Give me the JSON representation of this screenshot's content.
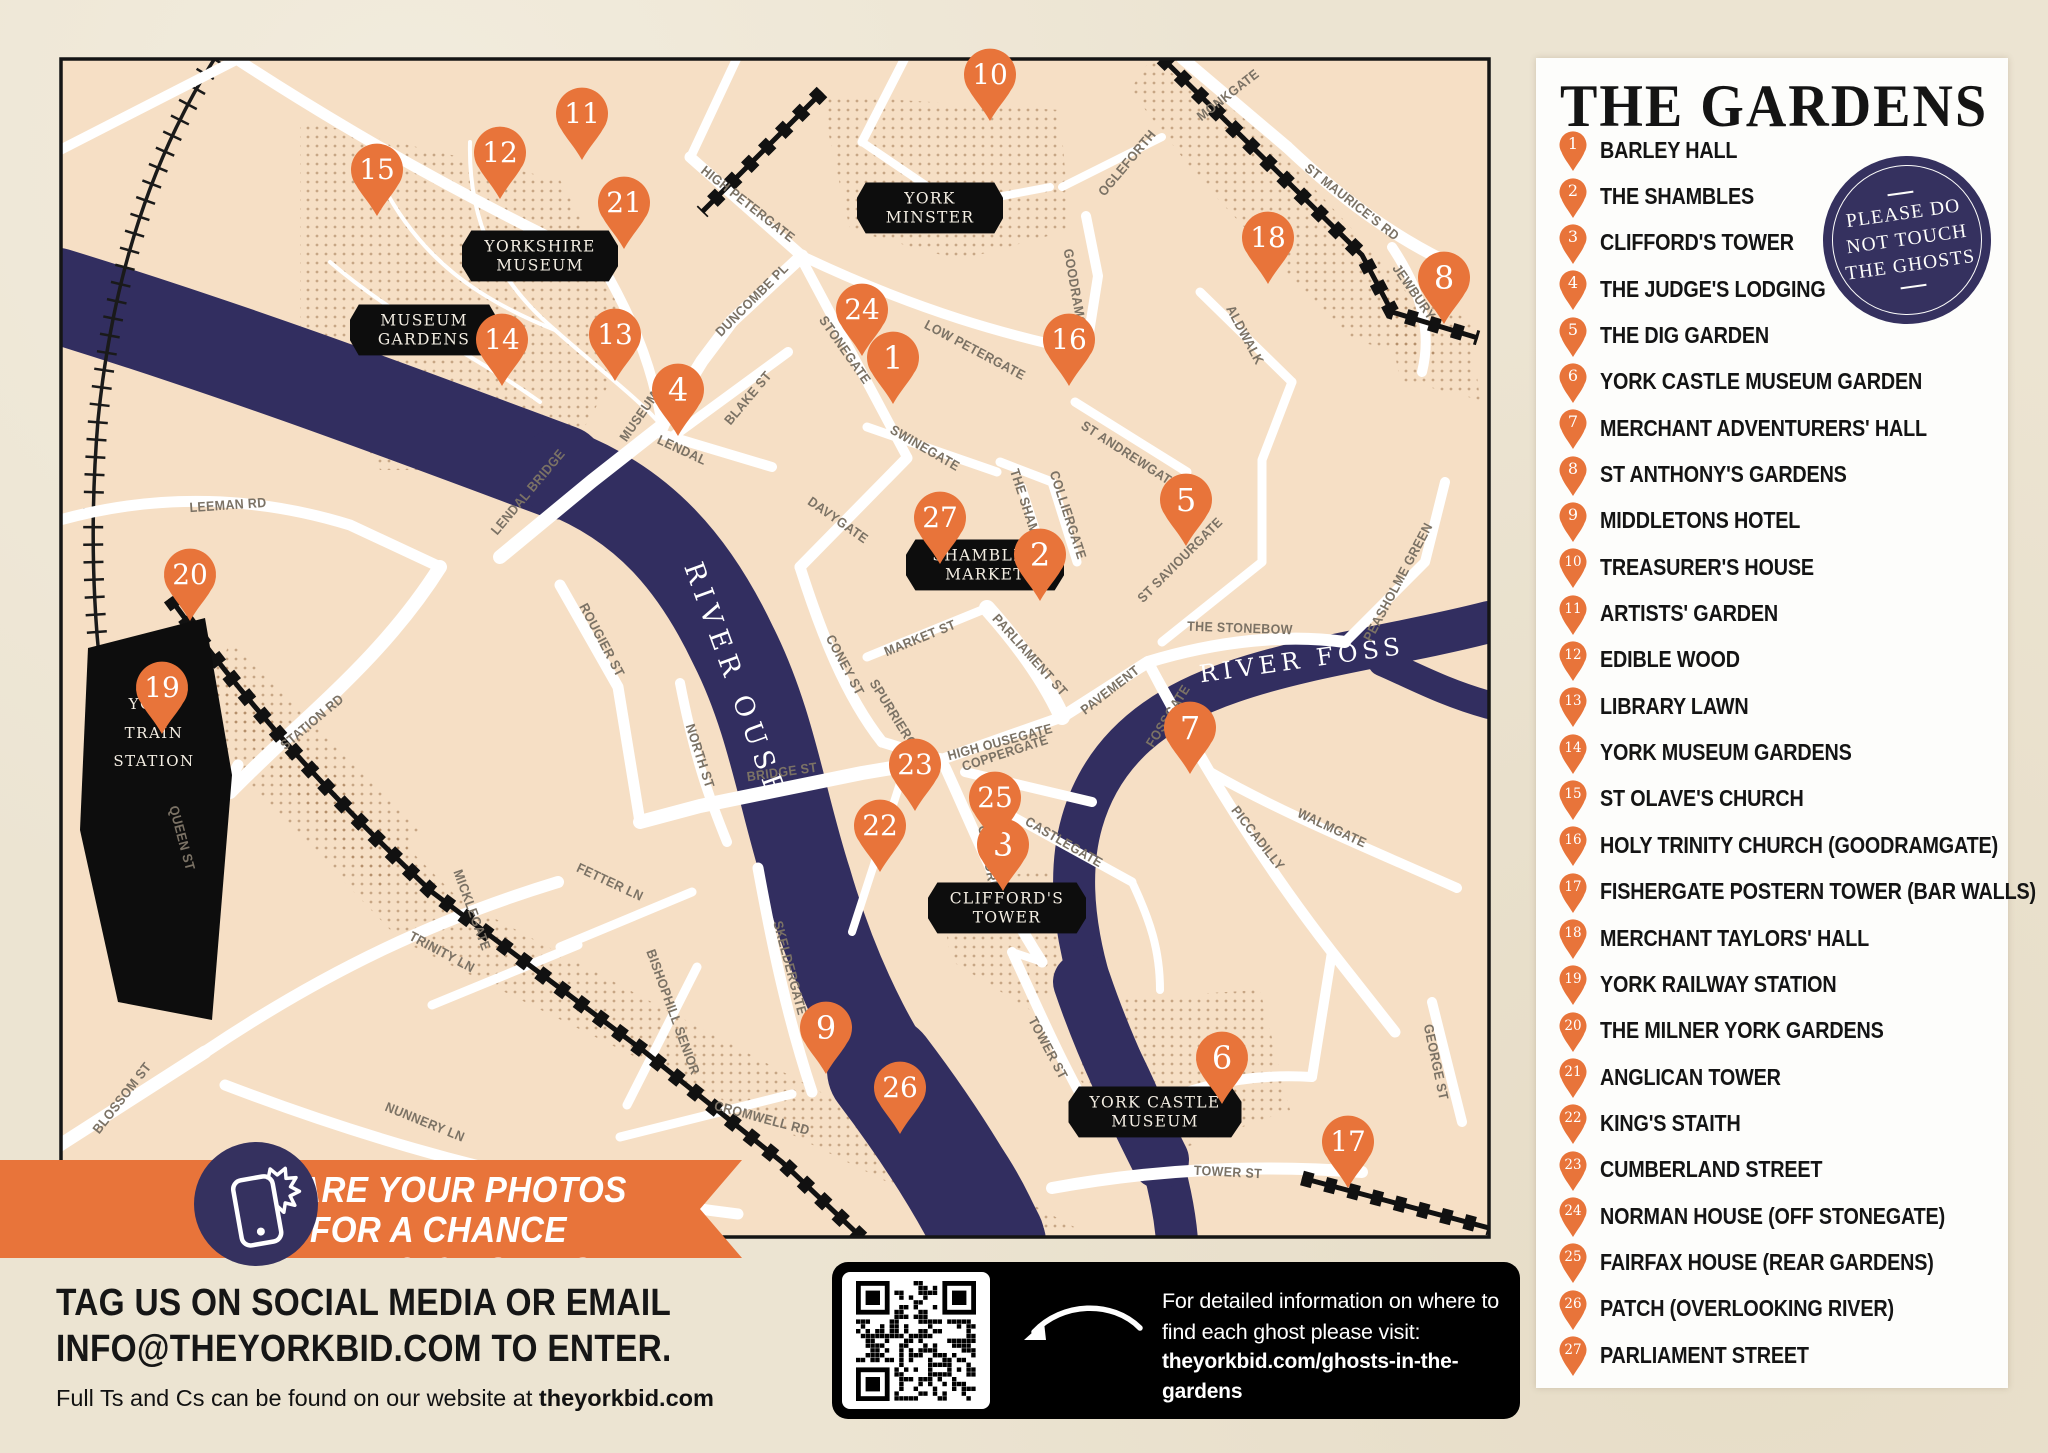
{
  "sidebar": {
    "title": "THE GARDENS",
    "badge": {
      "line1": "PLEASE DO",
      "line2": "NOT TOUCH",
      "line3": "THE GHOSTS"
    },
    "items": [
      {
        "num": "1",
        "label": "BARLEY HALL"
      },
      {
        "num": "2",
        "label": "THE SHAMBLES"
      },
      {
        "num": "3",
        "label": "CLIFFORD'S TOWER"
      },
      {
        "num": "4",
        "label": "THE JUDGE'S LODGING"
      },
      {
        "num": "5",
        "label": "THE DIG GARDEN"
      },
      {
        "num": "6",
        "label": "YORK CASTLE MUSEUM GARDEN"
      },
      {
        "num": "7",
        "label": "MERCHANT ADVENTURERS' HALL"
      },
      {
        "num": "8",
        "label": "ST ANTHONY'S GARDENS"
      },
      {
        "num": "9",
        "label": "MIDDLETONS HOTEL"
      },
      {
        "num": "10",
        "label": "TREASURER'S HOUSE"
      },
      {
        "num": "11",
        "label": "ARTISTS' GARDEN"
      },
      {
        "num": "12",
        "label": "EDIBLE WOOD"
      },
      {
        "num": "13",
        "label": "LIBRARY LAWN"
      },
      {
        "num": "14",
        "label": "YORK MUSEUM GARDENS"
      },
      {
        "num": "15",
        "label": "ST OLAVE'S CHURCH"
      },
      {
        "num": "16",
        "label": "HOLY TRINITY CHURCH (GOODRAMGATE)"
      },
      {
        "num": "17",
        "label": "FISHERGATE POSTERN TOWER (BAR WALLS)"
      },
      {
        "num": "18",
        "label": "MERCHANT TAYLORS' HALL"
      },
      {
        "num": "19",
        "label": "YORK RAILWAY STATION"
      },
      {
        "num": "20",
        "label": "THE MILNER YORK GARDENS"
      },
      {
        "num": "21",
        "label": "ANGLICAN TOWER"
      },
      {
        "num": "22",
        "label": "KING'S STAITH"
      },
      {
        "num": "23",
        "label": "CUMBERLAND STREET"
      },
      {
        "num": "24",
        "label": "NORMAN HOUSE (OFF STONEGATE)"
      },
      {
        "num": "25",
        "label": "FAIRFAX HOUSE (REAR GARDENS)"
      },
      {
        "num": "26",
        "label": "PATCH (OVERLOOKING RIVER)"
      },
      {
        "num": "27",
        "label": "PARLIAMENT STREET"
      }
    ]
  },
  "map": {
    "pins": [
      {
        "n": "1",
        "x": 893,
        "y": 358
      },
      {
        "n": "2",
        "x": 1040,
        "y": 555
      },
      {
        "n": "3",
        "x": 1003,
        "y": 845
      },
      {
        "n": "4",
        "x": 678,
        "y": 390
      },
      {
        "n": "5",
        "x": 1186,
        "y": 500
      },
      {
        "n": "6",
        "x": 1222,
        "y": 1058
      },
      {
        "n": "7",
        "x": 1190,
        "y": 728
      },
      {
        "n": "8",
        "x": 1444,
        "y": 278
      },
      {
        "n": "9",
        "x": 826,
        "y": 1028
      },
      {
        "n": "10",
        "x": 990,
        "y": 75
      },
      {
        "n": "11",
        "x": 582,
        "y": 114
      },
      {
        "n": "12",
        "x": 500,
        "y": 153
      },
      {
        "n": "13",
        "x": 615,
        "y": 335
      },
      {
        "n": "14",
        "x": 502,
        "y": 340
      },
      {
        "n": "15",
        "x": 377,
        "y": 170
      },
      {
        "n": "16",
        "x": 1069,
        "y": 340
      },
      {
        "n": "17",
        "x": 1348,
        "y": 1142
      },
      {
        "n": "18",
        "x": 1268,
        "y": 238
      },
      {
        "n": "19",
        "x": 162,
        "y": 688
      },
      {
        "n": "20",
        "x": 190,
        "y": 575
      },
      {
        "n": "21",
        "x": 624,
        "y": 203
      },
      {
        "n": "22",
        "x": 880,
        "y": 826
      },
      {
        "n": "23",
        "x": 915,
        "y": 765
      },
      {
        "n": "24",
        "x": 862,
        "y": 310
      },
      {
        "n": "25",
        "x": 995,
        "y": 798
      },
      {
        "n": "26",
        "x": 900,
        "y": 1088
      },
      {
        "n": "27",
        "x": 940,
        "y": 518
      }
    ],
    "plaques": [
      {
        "lines": [
          "YORK",
          "MINSTER"
        ],
        "x": 930,
        "y": 208,
        "w": 138
      },
      {
        "lines": [
          "YORKSHIRE",
          "MUSEUM"
        ],
        "x": 540,
        "y": 256,
        "w": 148
      },
      {
        "lines": [
          "MUSEUM",
          "GARDENS"
        ],
        "x": 424,
        "y": 330,
        "w": 140
      },
      {
        "lines": [
          "SHAMBLES",
          "MARKET"
        ],
        "x": 985,
        "y": 565,
        "w": 150
      },
      {
        "lines": [
          "CLIFFORD'S",
          "TOWER"
        ],
        "x": 1007,
        "y": 908,
        "w": 150
      },
      {
        "lines": [
          "YORK CASTLE",
          "MUSEUM"
        ],
        "x": 1155,
        "y": 1112,
        "w": 165
      }
    ],
    "station": {
      "lines": [
        "YORK",
        "TRAIN",
        "STATION"
      ]
    },
    "rivers": [
      {
        "name": "RIVER OUSE"
      },
      {
        "name": "RIVER FOSS"
      }
    ],
    "streets": [
      {
        "t": "MONKGATE",
        "x": 1228,
        "y": 95,
        "r": -38
      },
      {
        "t": "ST MAURICE'S RD",
        "x": 1352,
        "y": 202,
        "r": 38
      },
      {
        "t": "JEWBURY",
        "x": 1414,
        "y": 292,
        "r": 55
      },
      {
        "t": "ALDWALK",
        "x": 1245,
        "y": 335,
        "r": 62
      },
      {
        "t": "OGLEFORTH",
        "x": 1127,
        "y": 163,
        "r": -50
      },
      {
        "t": "HIGH PETERGATE",
        "x": 748,
        "y": 204,
        "r": 38
      },
      {
        "t": "DUNCOMBE PL",
        "x": 752,
        "y": 300,
        "r": -45
      },
      {
        "t": "MUSEUM ST",
        "x": 645,
        "y": 408,
        "r": -55
      },
      {
        "t": "LENDAL",
        "x": 682,
        "y": 450,
        "r": 25
      },
      {
        "t": "BLAKE ST",
        "x": 748,
        "y": 398,
        "r": -50
      },
      {
        "t": "STONEGATE",
        "x": 845,
        "y": 350,
        "r": 55
      },
      {
        "t": "LOW PETERGATE",
        "x": 975,
        "y": 350,
        "r": 28
      },
      {
        "t": "SWINEGATE",
        "x": 925,
        "y": 448,
        "r": 30
      },
      {
        "t": "GOODRAMGATE",
        "x": 1077,
        "y": 300,
        "r": 80
      },
      {
        "t": "ST ANDREWGATE",
        "x": 1130,
        "y": 455,
        "r": 33
      },
      {
        "t": "COLLIERGATE",
        "x": 1068,
        "y": 515,
        "r": 72
      },
      {
        "t": "THE SHAMBLES",
        "x": 1030,
        "y": 518,
        "r": 72
      },
      {
        "t": "ST SAVIOURGATE",
        "x": 1180,
        "y": 560,
        "r": -45
      },
      {
        "t": "THE STONEBOW",
        "x": 1240,
        "y": 628,
        "r": 2
      },
      {
        "t": "PEASHOLME GREEN",
        "x": 1398,
        "y": 582,
        "r": -62
      },
      {
        "t": "FOSSGATE",
        "x": 1168,
        "y": 716,
        "r": -58
      },
      {
        "t": "DAVYGATE",
        "x": 838,
        "y": 520,
        "r": 35
      },
      {
        "t": "CONEY ST",
        "x": 845,
        "y": 665,
        "r": 62
      },
      {
        "t": "MARKET ST",
        "x": 920,
        "y": 638,
        "r": -22
      },
      {
        "t": "SPURRIERGATE",
        "x": 900,
        "y": 724,
        "r": 58
      },
      {
        "t": "HIGH OUSEGATE",
        "x": 1000,
        "y": 742,
        "r": -15
      },
      {
        "t": "PARLIAMENT ST",
        "x": 1030,
        "y": 655,
        "r": 48
      },
      {
        "t": "PAVEMENT",
        "x": 1110,
        "y": 690,
        "r": -38
      },
      {
        "t": "COPPERGATE",
        "x": 1005,
        "y": 753,
        "r": -18
      },
      {
        "t": "CASTLEGATE",
        "x": 1064,
        "y": 842,
        "r": 30
      },
      {
        "t": "CLIFFORD ST",
        "x": 990,
        "y": 868,
        "r": 80
      },
      {
        "t": "PICCADILLY",
        "x": 1258,
        "y": 838,
        "r": 52
      },
      {
        "t": "WALMGATE",
        "x": 1332,
        "y": 828,
        "r": 25
      },
      {
        "t": "GEORGE ST",
        "x": 1436,
        "y": 1062,
        "r": 78
      },
      {
        "t": "TOWER ST",
        "x": 1048,
        "y": 1048,
        "r": 62
      },
      {
        "t": "TOWER ST",
        "x": 1228,
        "y": 1172,
        "r": 3
      },
      {
        "t": "BRIDGE ST",
        "x": 782,
        "y": 772,
        "r": -8
      },
      {
        "t": "NORTH ST",
        "x": 700,
        "y": 756,
        "r": 72
      },
      {
        "t": "SKELDERGATE",
        "x": 790,
        "y": 968,
        "r": 75
      },
      {
        "t": "BISHOPHILL SENIOR",
        "x": 673,
        "y": 1012,
        "r": 70
      },
      {
        "t": "CROMWELL RD",
        "x": 762,
        "y": 1118,
        "r": 15
      },
      {
        "t": "MICKLEGATE",
        "x": 472,
        "y": 910,
        "r": 70
      },
      {
        "t": "ROUGIER ST",
        "x": 602,
        "y": 640,
        "r": 62
      },
      {
        "t": "STATION RD",
        "x": 312,
        "y": 722,
        "r": -40
      },
      {
        "t": "LEEMAN RD",
        "x": 228,
        "y": 505,
        "r": -4
      },
      {
        "t": "QUEEN ST",
        "x": 182,
        "y": 838,
        "r": 75
      },
      {
        "t": "BLOSSOM ST",
        "x": 122,
        "y": 1098,
        "r": -52
      },
      {
        "t": "NUNNERY LN",
        "x": 425,
        "y": 1122,
        "r": 22
      },
      {
        "t": "TRINITY LN",
        "x": 442,
        "y": 952,
        "r": 28
      },
      {
        "t": "FETTER LN",
        "x": 610,
        "y": 882,
        "r": 25
      },
      {
        "t": "LENDAL BRIDGE",
        "x": 528,
        "y": 492,
        "r": -50
      }
    ]
  },
  "banner": {
    "line1": "SHARE YOUR PHOTOS FOR A CHANCE",
    "line2": "TO WIN A £50 YORK GIFT CARD!"
  },
  "footer": {
    "line1": "TAG US ON SOCIAL MEDIA OR EMAIL",
    "line2": "INFO@THEYORKBID.COM TO ENTER.",
    "small_prefix": "Full Ts and Cs can be found on our website at ",
    "small_bold": "theyorkbid.com"
  },
  "qr_panel": {
    "line1": "For detailed information on where to",
    "line2": "find each ghost please visit:",
    "line3": "theyorkbid.com/ghosts-in-the-gardens"
  },
  "icons": {
    "pin": "map-pin-icon",
    "phone": "selfie-phone-icon",
    "qr": "qr-code-icon",
    "arrow": "curved-arrow-icon"
  },
  "colors": {
    "accent_orange": "#E8743A",
    "navy": "#35315F",
    "river_navy": "#322E60",
    "map_cream": "#F6DFC5",
    "paper": "#ECE4D2",
    "plaque_black": "#0D0D0D",
    "road_white": "#FFFFFF"
  }
}
